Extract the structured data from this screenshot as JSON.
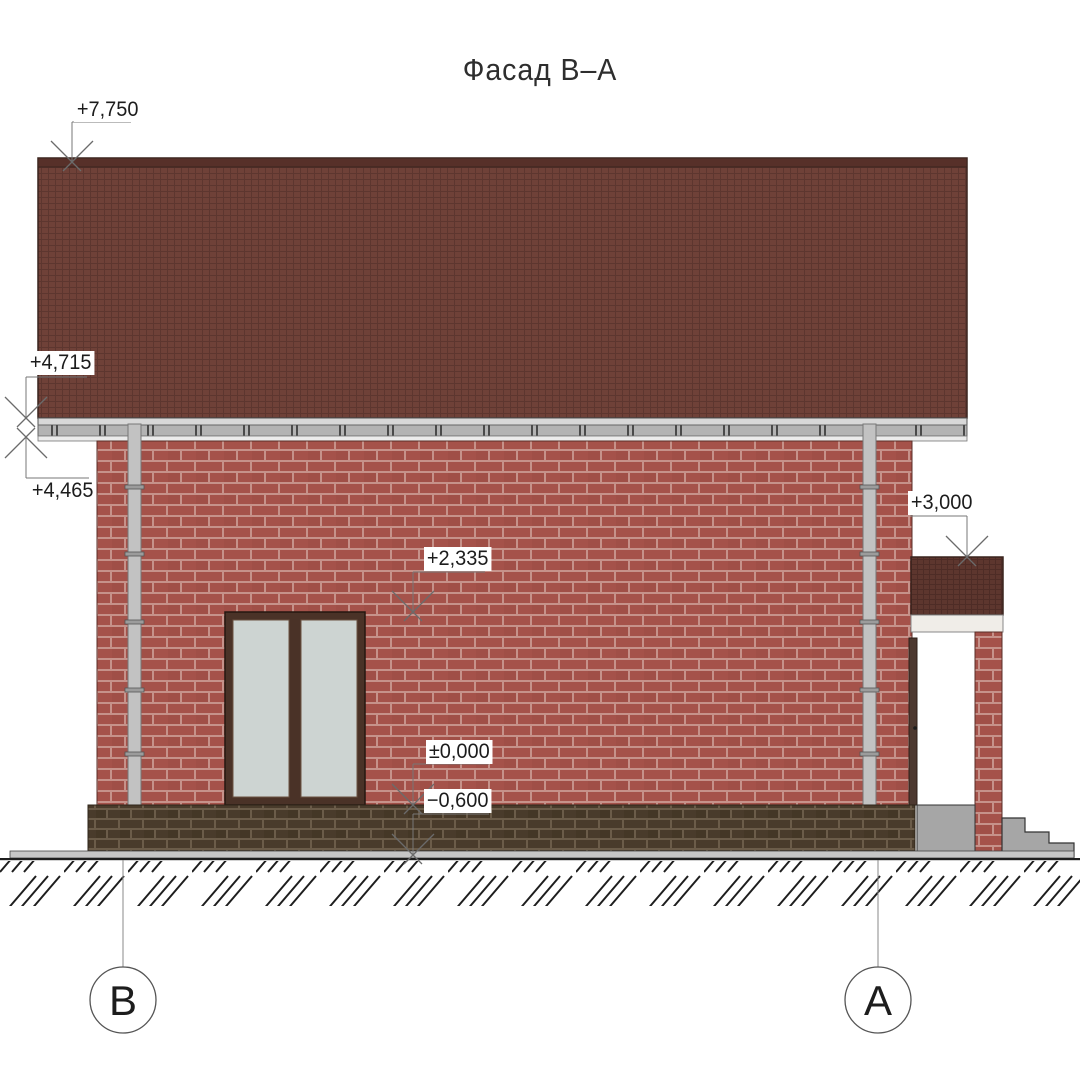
{
  "title": "Фасад В–А",
  "elevation_marks": {
    "ridge": "+7,750",
    "eaves_top": "+4,715",
    "eaves_bottom": "+4,465",
    "porch_roof": "+3,000",
    "window_head": "+2,335",
    "floor_level": "±0,000",
    "ground_level": "−0,600"
  },
  "axis_markers": {
    "left": "В",
    "right": "А"
  },
  "colors": {
    "roof_tile": "#6f4138",
    "roof_ridge": "#573029",
    "wall_brick": "#a5524a",
    "wall_mortar": "#c6928a",
    "plinth_brick": "#493b2b",
    "plinth_mortar": "#6b5c49",
    "gutter": "#d8d8d8",
    "soffit": "#b3b3b3",
    "fascia": "#ebebeb",
    "porch_fascia": "#f0ede8",
    "glass": "#cdd4d2",
    "window_frame": "#4a3227",
    "door": "#4d3930",
    "downpipe": "#c2c2c2",
    "concrete": "#a6a6a6",
    "ground_band": "#c6c6c6",
    "line": "#6b6b6b"
  }
}
